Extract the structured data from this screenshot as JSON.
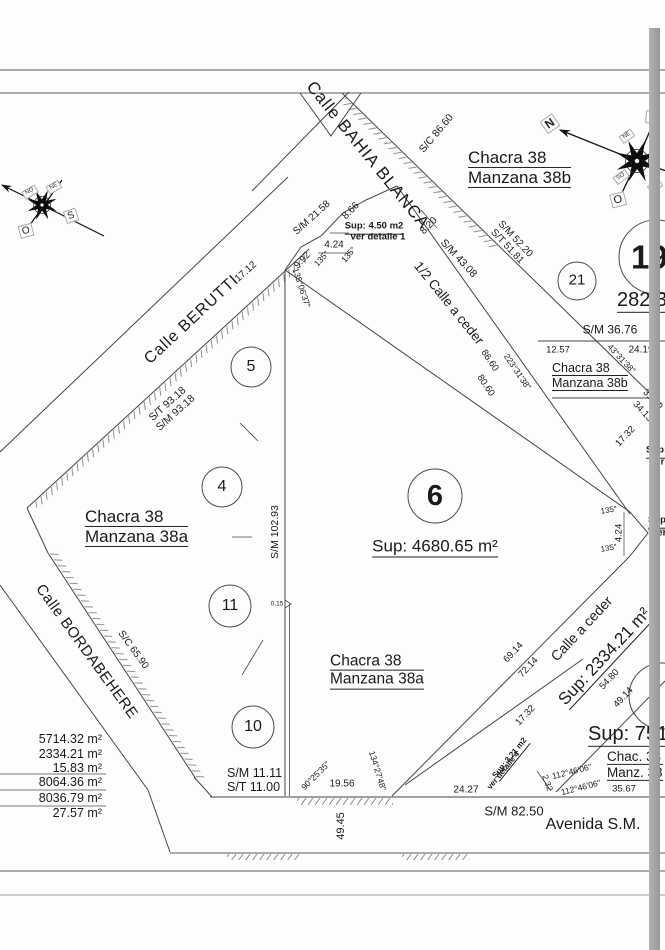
{
  "streets": {
    "bahia_blanca": "Calle BAHIA BLANCA",
    "berutti": "Calle BERUTTI",
    "bordabehere": "Calle BORDABEHERE",
    "avenida": "Avenida S.M.",
    "half_ceder": "1/2 Calle a ceder",
    "ceder": "Calle a ceder"
  },
  "blocks": {
    "chacra": "Chacra 38",
    "m38a": "Manzana 38a",
    "m38b": "Manzana 38b",
    "chac_ab": "Chac. 38",
    "manz_ab": "Manz. 38"
  },
  "parcels": {
    "p4": "4",
    "p5": "5",
    "p6": "6",
    "p10": "10",
    "p11": "11",
    "p19": "19",
    "p21": "21"
  },
  "areas": {
    "sup6": "Sup: 4680.65 m²",
    "sup_ceder": "Sup: 2334.21 m²",
    "sup751": "Sup: 751.",
    "a282": "282.3",
    "sup450": "Sup: 4.50 m2",
    "ver1": "ver detalle 1",
    "sup321": "Sup: 3.21 m2",
    "ver4": "ver detalle 4",
    "sup_cut": "Sup:",
    "ver_cut": "ver"
  },
  "area_table": {
    "r1": "5714.32 m²",
    "r2": "2334.21 m²",
    "r3": "15.83 m²",
    "r4": "8064.36 m²",
    "r5": "8036.79 m²",
    "r6": "27.57 m²"
  },
  "dims": {
    "sm2158": "S/M 21.58",
    "d866": "8.66",
    "d424": "4.24",
    "d992": "9.92",
    "d820": "8.20",
    "sm4308": "S/M 43.08",
    "sc8660": "S/C 86.60",
    "sm5220": "S/M 52.20",
    "st5181": "S/T 51.81",
    "d1712": "17.12",
    "st9318": "S/T 93.18",
    "sm9318": "S/M 93.18",
    "sm10293": "S/M 102.93",
    "d015": "0.15",
    "sc6590": "S/C 65.90",
    "sm3676": "S/M 36.76",
    "d1257": "12.57",
    "d2419": "24.19",
    "d3140": "31.40",
    "d3413": "34.13",
    "d1732": "17.32",
    "d8660": "86.60",
    "d8060": "80.60",
    "d6914": "69.14",
    "d7214": "72.14",
    "d5480": "54.80",
    "d4914": "49.14",
    "sm1111": "S/M 11.11",
    "st1100": "S/T 11.00",
    "d1956": "19.56",
    "d4945": "49.45",
    "d2427": "24.27",
    "sm8250": "S/M 82.50",
    "d3567": "35.67",
    "d232": "2.32"
  },
  "angles": {
    "a135": "135°",
    "a1350637": "135°06'37\"",
    "a2233138": "223°31'38\"",
    "a433138": "43°31'38\"",
    "a902535": "90°25'35\"",
    "a1342748": "134°27'48\"",
    "a1124606": "112°46'06\""
  },
  "compass": {
    "n": "N",
    "e": "E",
    "o": "O",
    "s": "S",
    "ne": "NE",
    "se": "SE",
    "so": "SO",
    "no": "NO"
  }
}
